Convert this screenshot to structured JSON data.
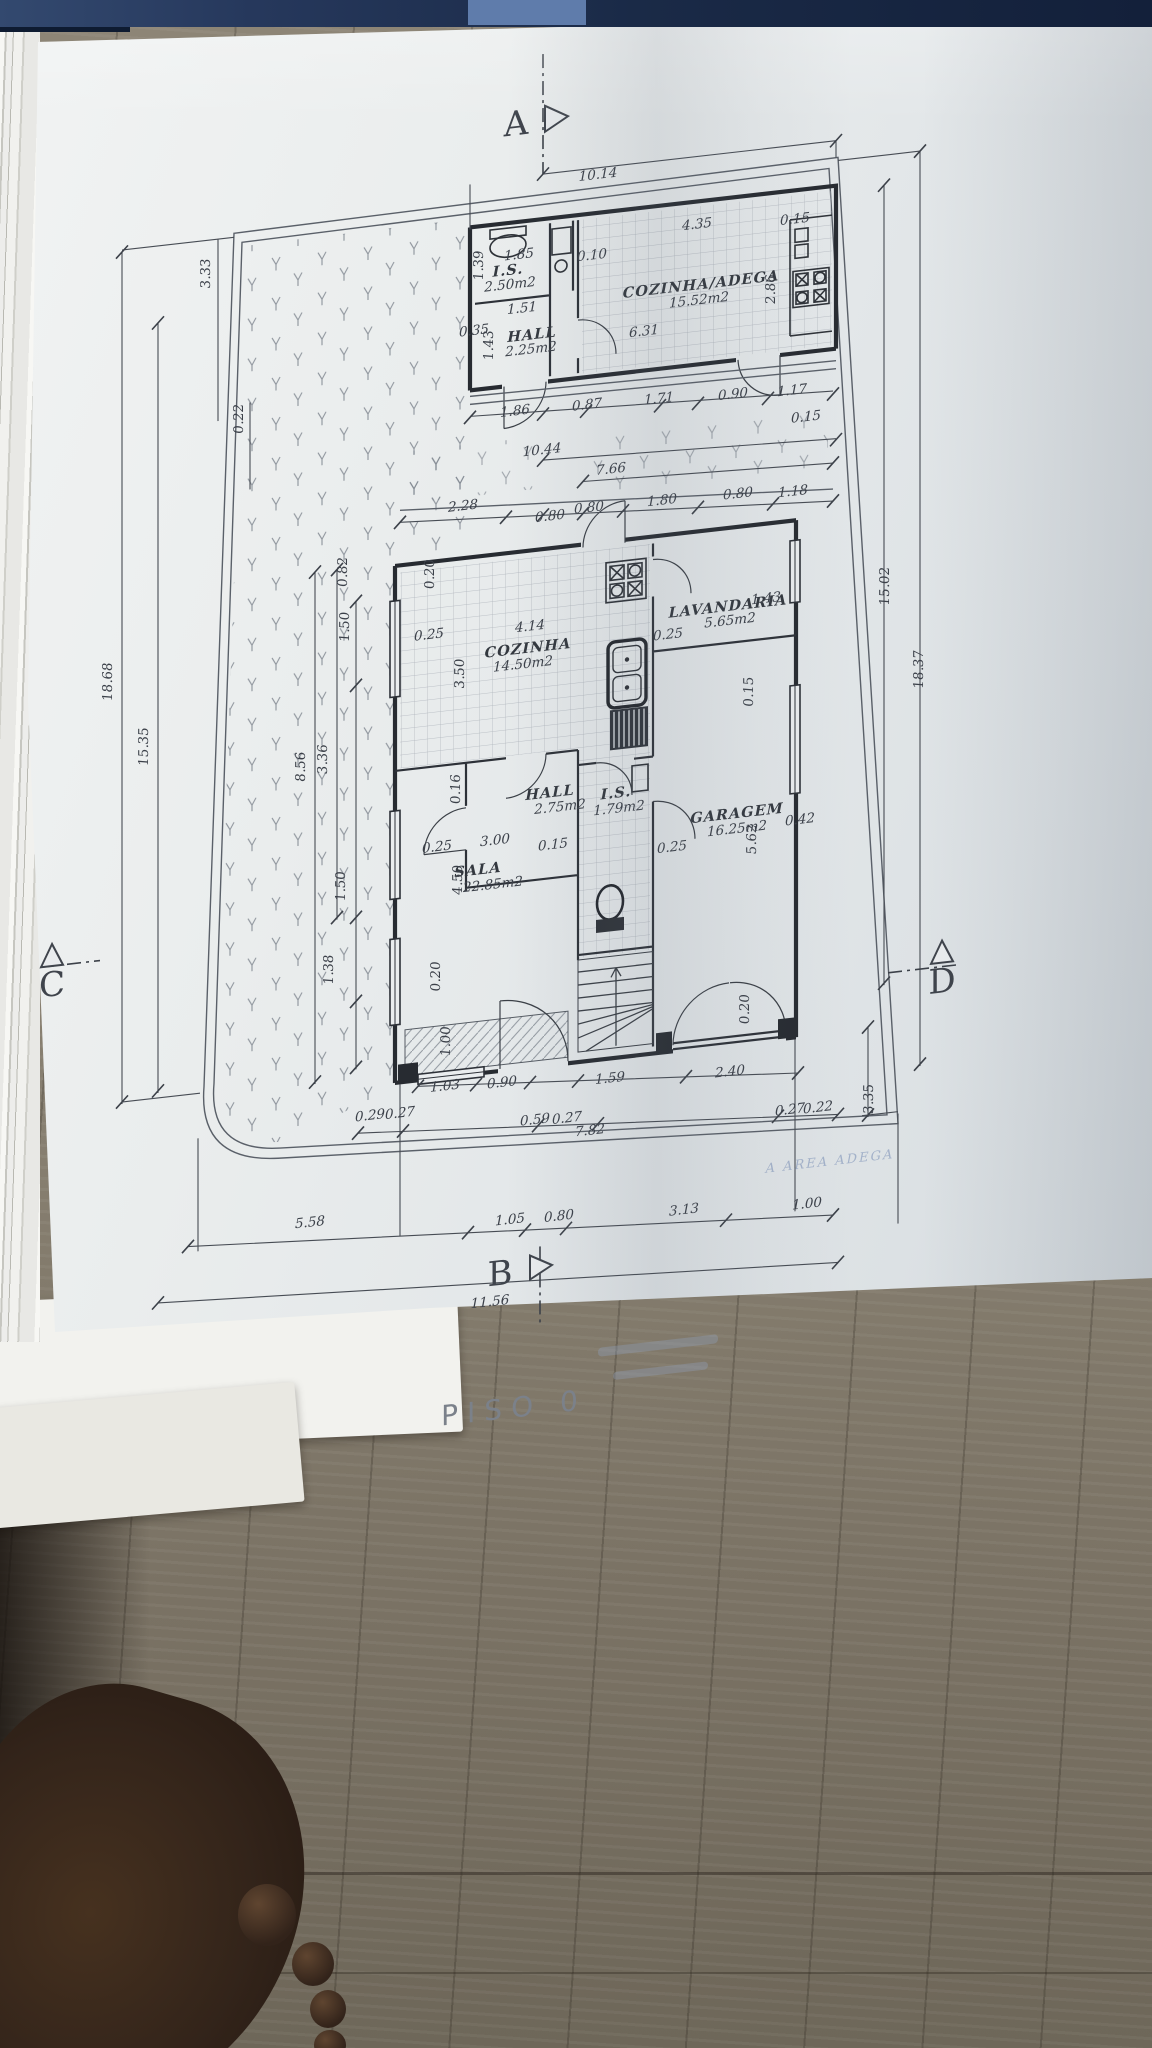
{
  "drawing": {
    "title": "PISO 0",
    "floor_level_label": "PISO  0",
    "rooms": [
      {
        "name": "I.S.",
        "area": "2.50m2"
      },
      {
        "name": "HALL",
        "area": "2.25m2"
      },
      {
        "name": "COZINHA/ADEGA",
        "area": "15.52m2"
      },
      {
        "name": "COZINHA",
        "area": "14.50m2"
      },
      {
        "name": "LAVANDARIA",
        "area": "5.65m2"
      },
      {
        "name": "HALL",
        "area": "2.75m2"
      },
      {
        "name": "I.S.",
        "area": "1.79m2"
      },
      {
        "name": "GARAGEM",
        "area": "16.25m2"
      },
      {
        "name": "SALA",
        "area": "22.85m2"
      }
    ],
    "section_markers": [
      "A",
      "B",
      "C",
      "D"
    ],
    "labels": [
      {
        "t": "A",
        "x": 478,
        "y": 108,
        "k": "m"
      },
      {
        "t": "10.14",
        "x": 560,
        "y": 161,
        "k": "d"
      },
      {
        "t": "1.85",
        "x": 481,
        "y": 232,
        "k": "d"
      },
      {
        "t": "1.39",
        "x": 445,
        "y": 234,
        "k": "d",
        "v": 1
      },
      {
        "t": "I.S.",
        "x": 470,
        "y": 247,
        "k": "r",
        "s": 13
      },
      {
        "t": "2.50m2",
        "x": 472,
        "y": 261,
        "k": "a"
      },
      {
        "t": "1.51",
        "x": 484,
        "y": 286,
        "k": "d"
      },
      {
        "t": "0.35",
        "x": 436,
        "y": 303,
        "k": "d",
        "s": 11
      },
      {
        "t": "1.43",
        "x": 455,
        "y": 315,
        "k": "d",
        "v": 1,
        "s": 11
      },
      {
        "t": "HALL",
        "x": 494,
        "y": 314,
        "k": "r",
        "s": 13
      },
      {
        "t": "2.25m2",
        "x": 493,
        "y": 328,
        "k": "a"
      },
      {
        "t": "0.10",
        "x": 554,
        "y": 241,
        "k": "d"
      },
      {
        "t": "4.35",
        "x": 659,
        "y": 222,
        "k": "d"
      },
      {
        "t": "0.15",
        "x": 757,
        "y": 228,
        "k": "d"
      },
      {
        "t": "2.86",
        "x": 737,
        "y": 291,
        "k": "d",
        "v": 1
      },
      {
        "t": "COZINHA/ADEGA",
        "x": 663,
        "y": 283,
        "k": "r",
        "s": 13
      },
      {
        "t": "15.52m2",
        "x": 661,
        "y": 298,
        "k": "a"
      },
      {
        "t": "6.31",
        "x": 606,
        "y": 323,
        "k": "d"
      },
      {
        "t": "1.86",
        "x": 477,
        "y": 388,
        "k": "d"
      },
      {
        "t": "0.87",
        "x": 549,
        "y": 390,
        "k": "d"
      },
      {
        "t": "1.71",
        "x": 621,
        "y": 392,
        "k": "d"
      },
      {
        "t": "0.90",
        "x": 695,
        "y": 396,
        "k": "d"
      },
      {
        "t": "1.17",
        "x": 754,
        "y": 399,
        "k": "d"
      },
      {
        "t": "0.15",
        "x": 768,
        "y": 427,
        "k": "d"
      },
      {
        "t": "10.44",
        "x": 504,
        "y": 430,
        "k": "d"
      },
      {
        "t": "7.66",
        "x": 573,
        "y": 457,
        "k": "d"
      },
      {
        "t": "2.28",
        "x": 425,
        "y": 477,
        "k": "d"
      },
      {
        "t": "0.80",
        "x": 512,
        "y": 497,
        "k": "d"
      },
      {
        "t": "0.80",
        "x": 551,
        "y": 493,
        "k": "d"
      },
      {
        "t": "1.80",
        "x": 624,
        "y": 494,
        "k": "d"
      },
      {
        "t": "0.80",
        "x": 700,
        "y": 496,
        "k": "d"
      },
      {
        "t": "1.18",
        "x": 755,
        "y": 500,
        "k": "d"
      },
      {
        "t": "0.82",
        "x": 309,
        "y": 525,
        "k": "d",
        "v": 1
      },
      {
        "t": "0.20",
        "x": 396,
        "y": 537,
        "k": "d",
        "v": 1
      },
      {
        "t": "0.25",
        "x": 391,
        "y": 602,
        "k": "d"
      },
      {
        "t": "4.14",
        "x": 492,
        "y": 605,
        "k": "d"
      },
      {
        "t": "COZINHA",
        "x": 490,
        "y": 627,
        "k": "r"
      },
      {
        "t": "14.50m2",
        "x": 485,
        "y": 642,
        "k": "a"
      },
      {
        "t": "3.50",
        "x": 426,
        "y": 640,
        "k": "d",
        "v": 1
      },
      {
        "t": "0.25",
        "x": 630,
        "y": 629,
        "k": "d"
      },
      {
        "t": "LAVANDARIA",
        "x": 690,
        "y": 608,
        "k": "r",
        "s": 13
      },
      {
        "t": "5.65m2",
        "x": 692,
        "y": 622,
        "k": "a"
      },
      {
        "t": "1.43",
        "x": 728,
        "y": 604,
        "k": "d",
        "s": 10
      },
      {
        "t": "0.15",
        "x": 715,
        "y": 691,
        "k": "d",
        "v": 1
      },
      {
        "t": "0.16",
        "x": 422,
        "y": 755,
        "k": "d",
        "v": 1
      },
      {
        "t": "HALL",
        "x": 512,
        "y": 774,
        "k": "r",
        "s": 13
      },
      {
        "t": "2.75m2",
        "x": 522,
        "y": 789,
        "k": "a"
      },
      {
        "t": "I.S.",
        "x": 578,
        "y": 782,
        "k": "r",
        "s": 12
      },
      {
        "t": "1.79m2",
        "x": 581,
        "y": 797,
        "k": "a",
        "s": 12
      },
      {
        "t": "GARAGEM",
        "x": 699,
        "y": 816,
        "k": "r"
      },
      {
        "t": "16.25m2",
        "x": 699,
        "y": 831,
        "k": "a"
      },
      {
        "t": "5.62",
        "x": 718,
        "y": 839,
        "k": "d",
        "v": 1
      },
      {
        "t": "0.42",
        "x": 762,
        "y": 829,
        "k": "d"
      },
      {
        "t": "3.00",
        "x": 457,
        "y": 815,
        "k": "d"
      },
      {
        "t": "0.15",
        "x": 515,
        "y": 826,
        "k": "d"
      },
      {
        "t": "0.25",
        "x": 399,
        "y": 815,
        "k": "d"
      },
      {
        "t": "0.25",
        "x": 634,
        "y": 842,
        "k": "d"
      },
      {
        "t": "SALA",
        "x": 440,
        "y": 843,
        "k": "r"
      },
      {
        "t": "22.85m2",
        "x": 455,
        "y": 859,
        "k": "a"
      },
      {
        "t": "4.50",
        "x": 424,
        "y": 846,
        "k": "d",
        "v": 1
      },
      {
        "t": "3.33",
        "x": 172,
        "y": 211,
        "k": "d",
        "v": 1
      },
      {
        "t": "0.22",
        "x": 205,
        "y": 360,
        "k": "d",
        "v": 1
      },
      {
        "t": "18.68",
        "x": 74,
        "y": 608,
        "k": "d",
        "v": 1
      },
      {
        "t": "15.35",
        "x": 110,
        "y": 677,
        "k": "d",
        "v": 1
      },
      {
        "t": "8.56",
        "x": 267,
        "y": 715,
        "k": "d",
        "v": 1
      },
      {
        "t": "3.36",
        "x": 289,
        "y": 710,
        "k": "d",
        "v": 1
      },
      {
        "t": "1.50",
        "x": 311,
        "y": 580,
        "k": "d",
        "v": 1
      },
      {
        "t": "1.50",
        "x": 307,
        "y": 839,
        "k": "d",
        "v": 1
      },
      {
        "t": "1.38",
        "x": 295,
        "y": 921,
        "k": "d",
        "v": 1
      },
      {
        "t": "0.20",
        "x": 402,
        "y": 940,
        "k": "d",
        "v": 1
      },
      {
        "t": "1.00",
        "x": 412,
        "y": 1006,
        "k": "d",
        "v": 1
      },
      {
        "t": "15.02",
        "x": 851,
        "y": 601,
        "k": "d",
        "v": 1
      },
      {
        "t": "18.37",
        "x": 885,
        "y": 688,
        "k": "d",
        "v": 1
      },
      {
        "t": "0.20",
        "x": 711,
        "y": 1008,
        "k": "d",
        "v": 1
      },
      {
        "t": "3.35",
        "x": 835,
        "y": 1112,
        "k": "d",
        "v": 1
      },
      {
        "t": "1.03",
        "x": 407,
        "y": 1055,
        "k": "d"
      },
      {
        "t": "0.90",
        "x": 464,
        "y": 1058,
        "k": "d"
      },
      {
        "t": "1.59",
        "x": 572,
        "y": 1066,
        "k": "d"
      },
      {
        "t": "2.40",
        "x": 692,
        "y": 1073,
        "k": "d"
      },
      {
        "t": "0.29",
        "x": 332,
        "y": 1076,
        "k": "d",
        "s": 11
      },
      {
        "t": "0.27",
        "x": 362,
        "y": 1077,
        "k": "d",
        "s": 11
      },
      {
        "t": "0.59",
        "x": 497,
        "y": 1099,
        "k": "d",
        "s": 11
      },
      {
        "t": "0.27",
        "x": 529,
        "y": 1101,
        "k": "d",
        "s": 11
      },
      {
        "t": "7.82",
        "x": 552,
        "y": 1116,
        "k": "d"
      },
      {
        "t": "0.27",
        "x": 752,
        "y": 1118,
        "k": "d",
        "s": 11
      },
      {
        "t": "0.22",
        "x": 780,
        "y": 1119,
        "k": "d",
        "s": 11
      },
      {
        "t": "5.58",
        "x": 272,
        "y": 1176,
        "k": "d"
      },
      {
        "t": "1.05",
        "x": 472,
        "y": 1196,
        "k": "d"
      },
      {
        "t": "0.80",
        "x": 521,
        "y": 1198,
        "k": "d"
      },
      {
        "t": "3.13",
        "x": 646,
        "y": 1206,
        "k": "d"
      },
      {
        "t": "1.00",
        "x": 769,
        "y": 1214,
        "k": "d"
      },
      {
        "t": "B",
        "x": 462,
        "y": 1256,
        "k": "m"
      },
      {
        "t": "11.56",
        "x": 452,
        "y": 1276,
        "k": "d"
      },
      {
        "t": "C",
        "x": 14,
        "y": 916,
        "k": "m",
        "s": 30
      },
      {
        "t": "D",
        "x": 904,
        "y": 1014,
        "k": "m",
        "s": 30
      },
      {
        "t": "PISO  0",
        "x": 476,
        "y": 1390,
        "k": "t"
      },
      {
        "t": "A AREA ADEGA",
        "x": 792,
        "y": 1174,
        "k": "s"
      }
    ]
  },
  "colors": {
    "paper": "#e6eaec",
    "ink": "#3b4049",
    "top_strip_navy": "#1a2a47",
    "stamp_blue": "#7d92b8",
    "wood_floor": "#857d6e"
  }
}
